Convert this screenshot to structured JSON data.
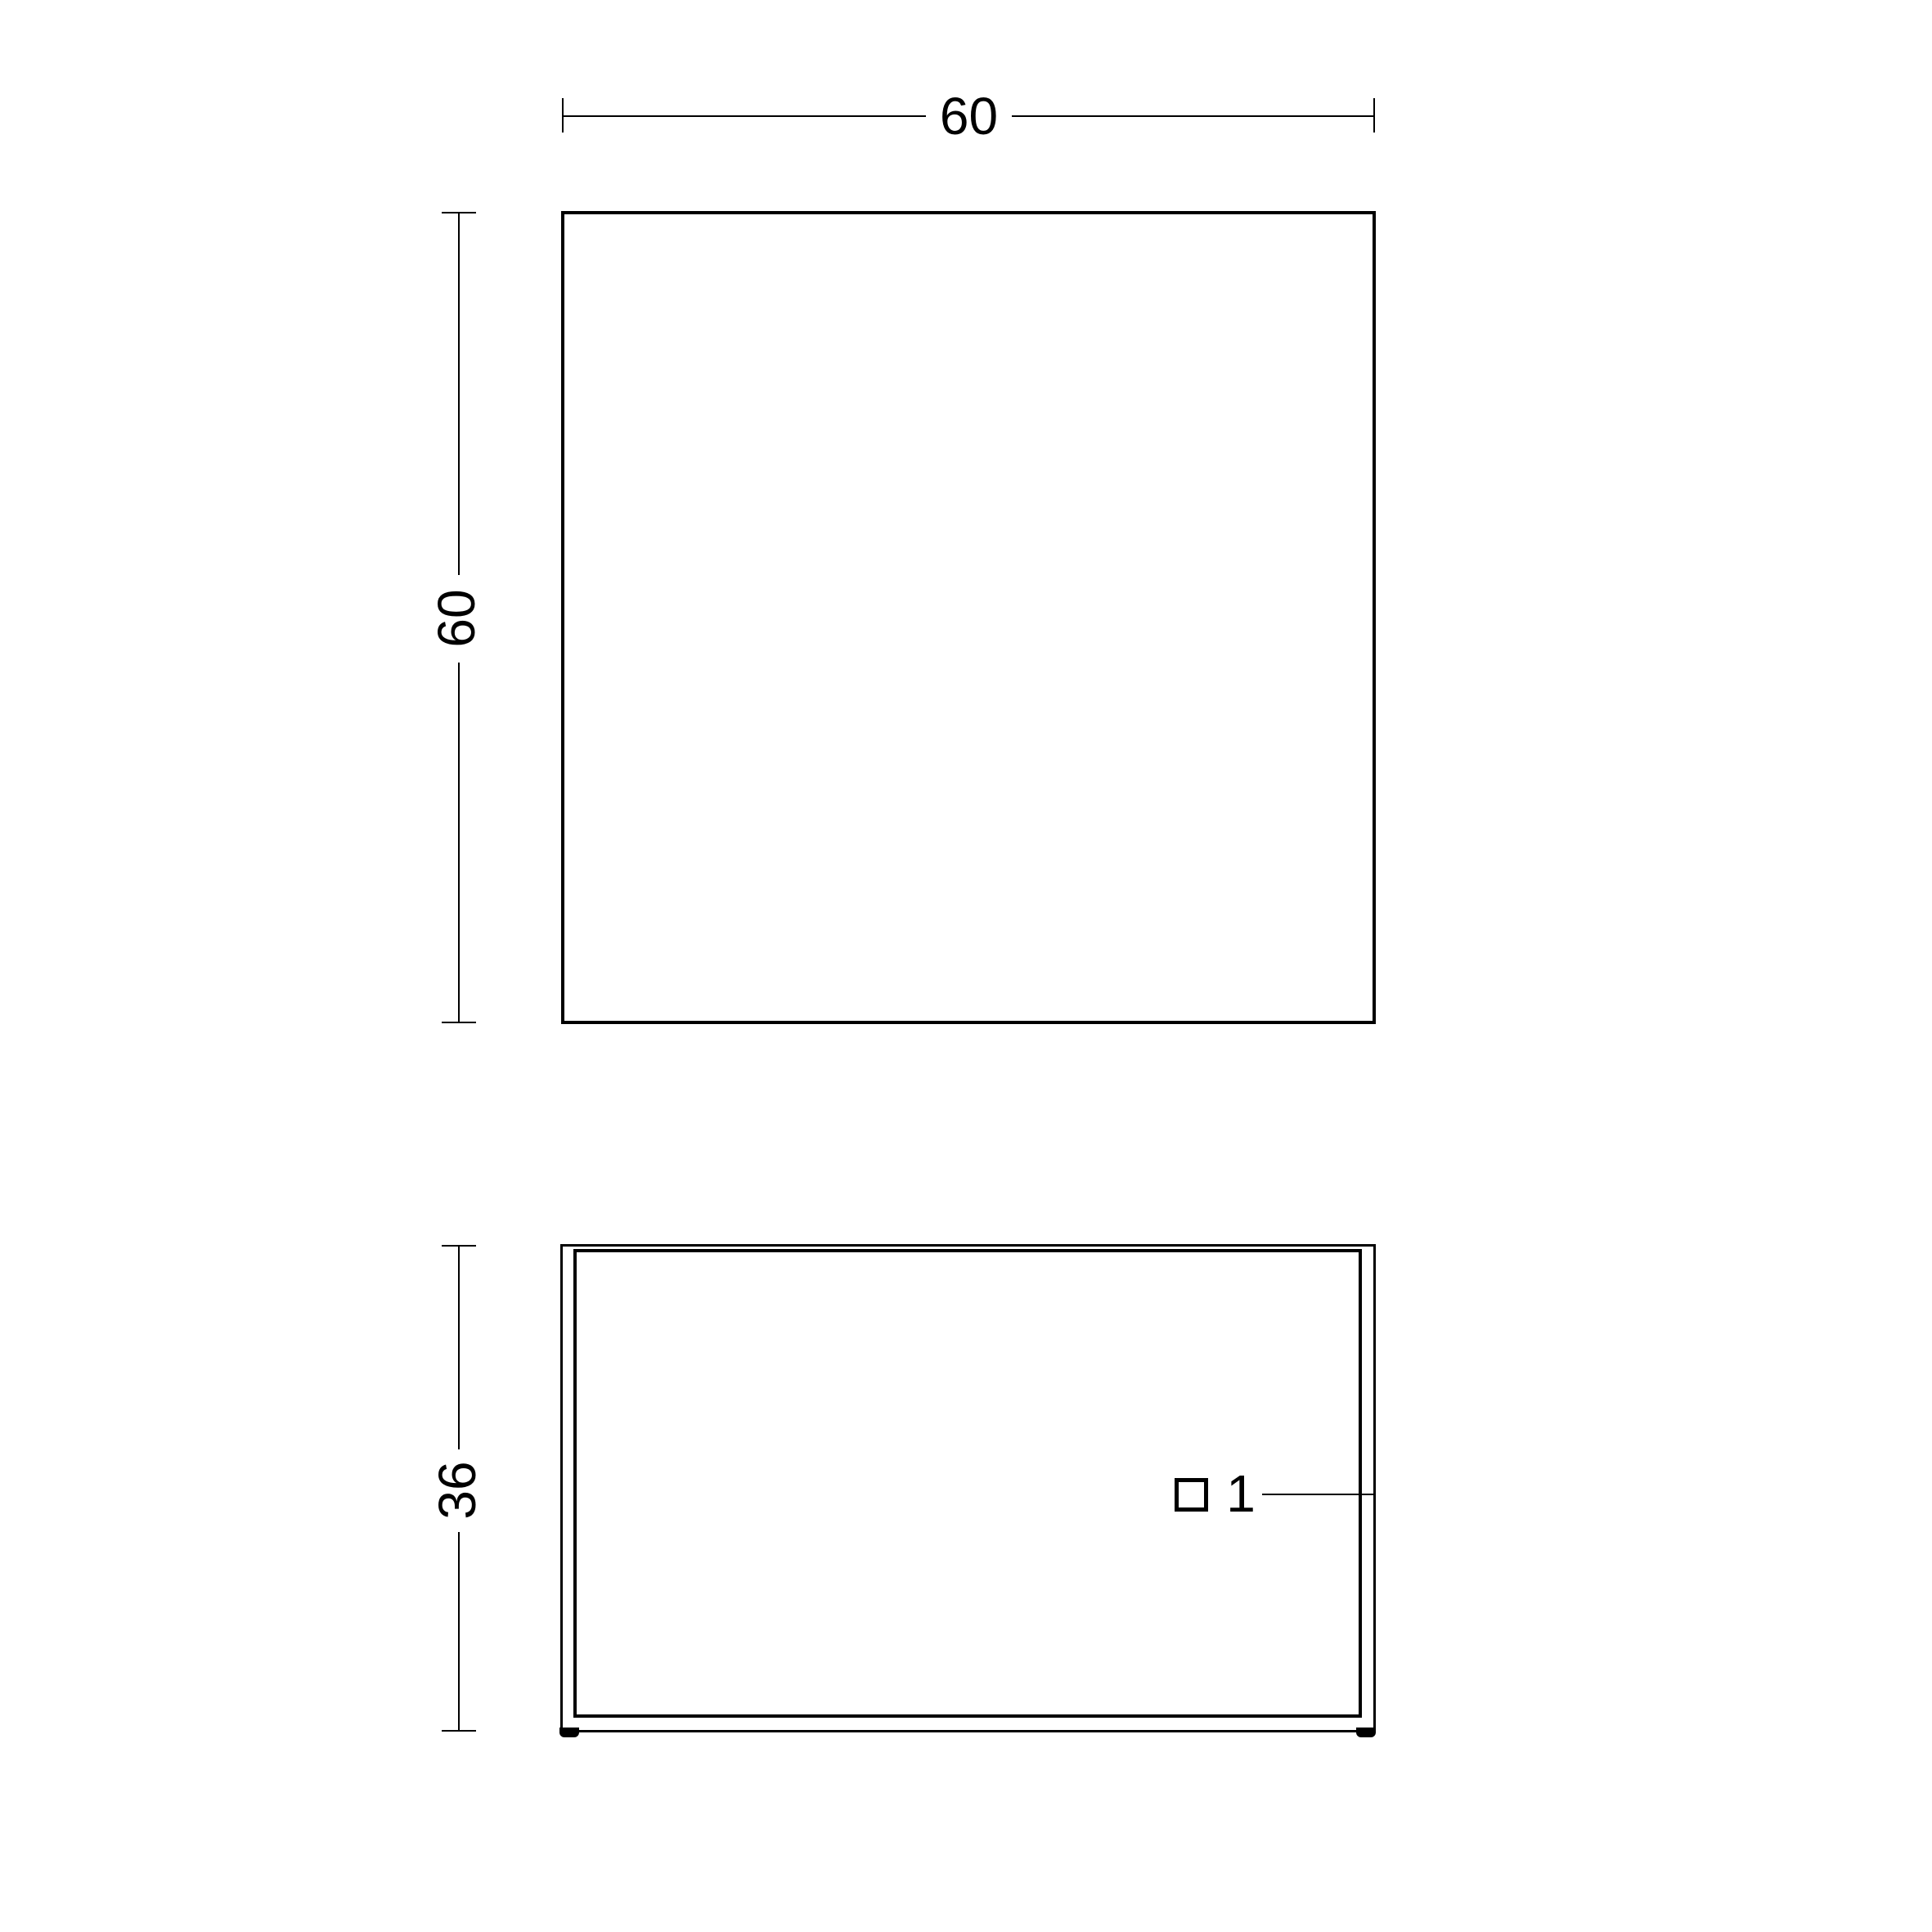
{
  "drawing": {
    "background_color": "#ffffff",
    "line_color": "#000000",
    "views": {
      "plan": {
        "width_dim": "60",
        "depth_dim": "60"
      },
      "front": {
        "height_dim": "36"
      }
    },
    "callout": {
      "marker_shape": "square-outline",
      "label": "1"
    }
  }
}
